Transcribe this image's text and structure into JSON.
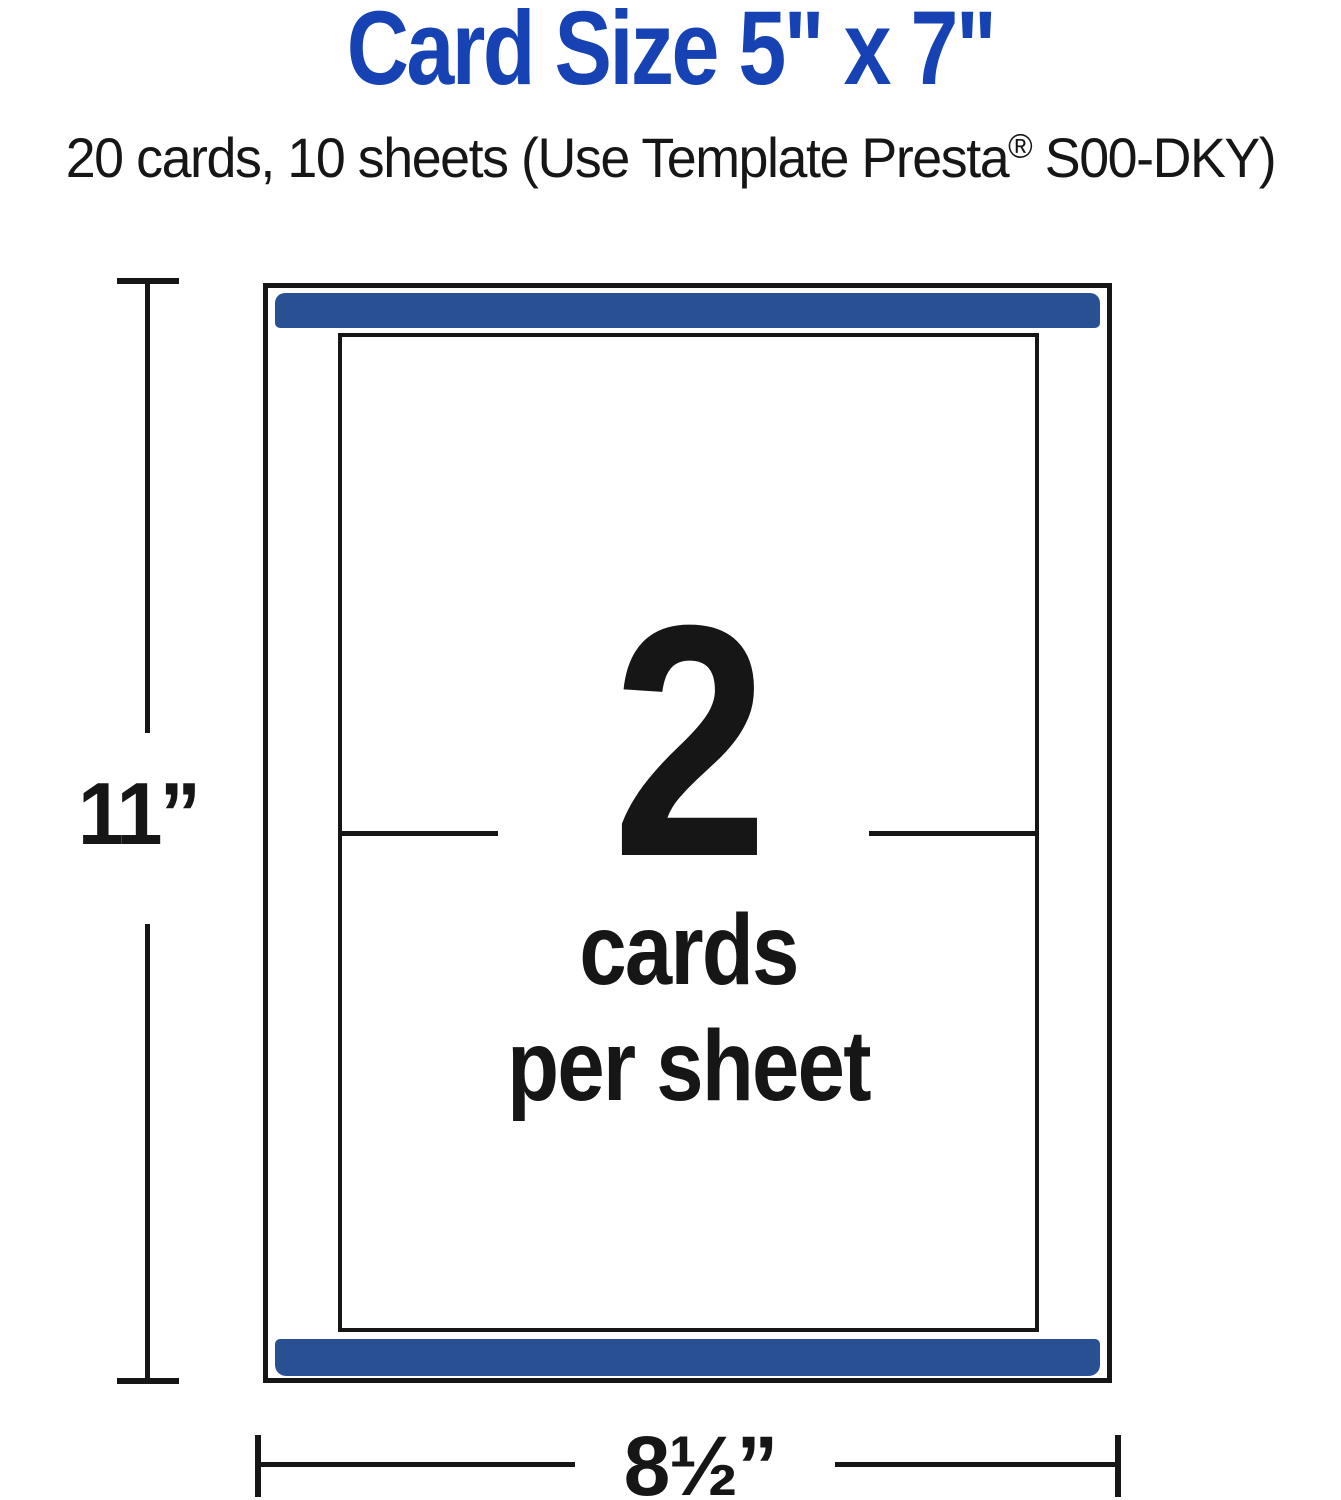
{
  "title": "Card Size 5\" x 7\"",
  "subtitle": {
    "prefix": "20 cards, 10 sheets (Use Template Presta",
    "registered": "®",
    "suffix": " S00-DKY)"
  },
  "diagram": {
    "count": "2",
    "caption_line1": "cards",
    "caption_line2": "per sheet"
  },
  "dimensions": {
    "height_label": "11”",
    "width_label": "8½”"
  },
  "colors": {
    "title_blue": "#1642b4",
    "bar_blue": "#2a5094",
    "ink": "#161616"
  }
}
